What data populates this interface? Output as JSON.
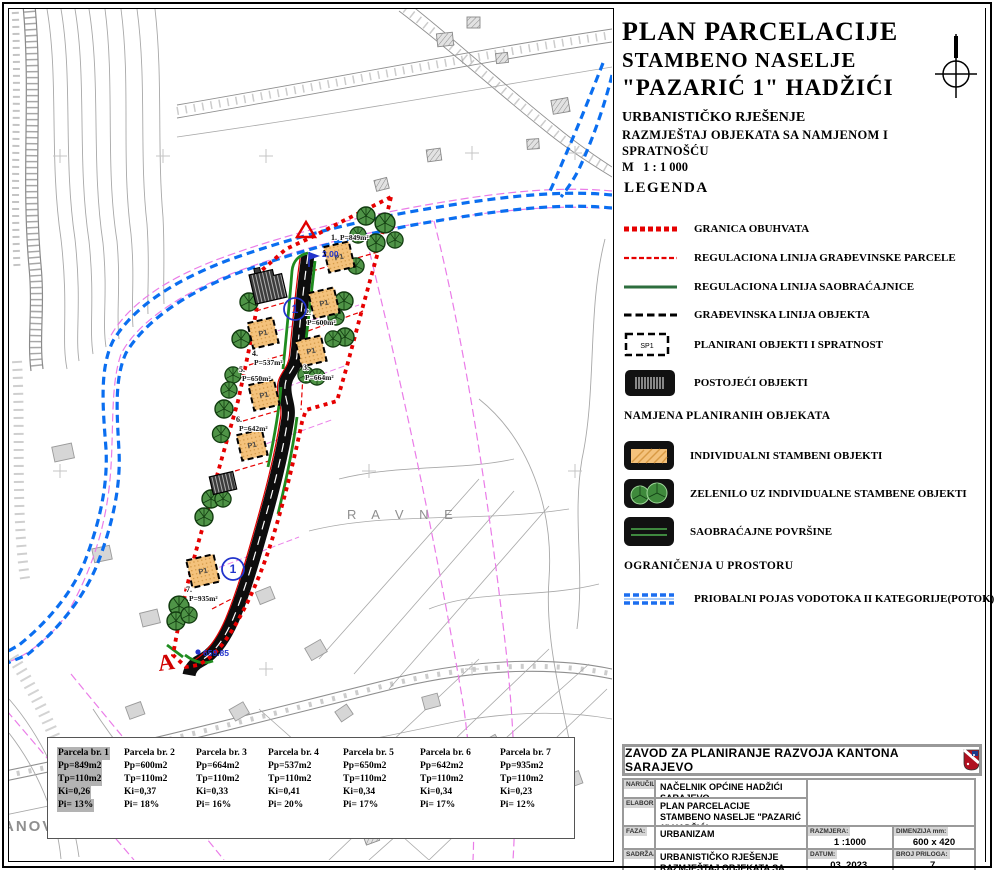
{
  "title_block": {
    "line1": "PLAN PARCELACIJE",
    "line2": "STAMBENO NASELJE",
    "line3": "\"PAZARIĆ 1\" HADŽIĆI",
    "subtitle1": "URBANISTIČKO RJEŠENJE",
    "subtitle2": "RAZMJEŠTAJ OBJEKATA SA NAMJENOM I SPRATNOŠĆU",
    "scale": "M   1 : 1 000"
  },
  "legend": {
    "heading": "LEGENDA",
    "items": [
      {
        "label": "GRANICA OBUHVATA"
      },
      {
        "label": "REGULACIONA LINIJA GRAĐEVINSKE PARCELE"
      },
      {
        "label": "REGULACIONA LINIJA  SAOBRAĆAJNICE"
      },
      {
        "label": "GRAĐEVINSKA LINIJA OBJEKTA"
      },
      {
        "label": "PLANIRANI OBJEKTI I SPRATNOST",
        "symbol_text": "SP1"
      },
      {
        "label": "POSTOJEĆI OBJEKTI"
      }
    ],
    "namjena_heading": "NAMJENA PLANIRANIH OBJEKATA",
    "namjena_items": [
      {
        "label": "INDIVIDUALNI STAMBENI OBJEKTI"
      },
      {
        "label": "ZELENILO UZ INDIVIDUALNE STAMBENE OBJEKTI"
      },
      {
        "label": "SAOBRAĆAJNE POVRŠINE"
      }
    ],
    "ogranicenja_heading": "OGRANIČENJA U PROSTORU",
    "ogranicenja_items": [
      {
        "label": "PRIOBALNI POJAS VODOTOKA  II KATEGORIJE(POTOK)"
      }
    ]
  },
  "parcels": [
    {
      "title": "Parcela br. 1",
      "pp": "Pp=849m2",
      "tp": "Tp=110m2",
      "ki": "Ki=0,26",
      "pi": "Pi= 13%",
      "highlight": true
    },
    {
      "title": "Parcela br. 2",
      "pp": "Pp=600m2",
      "tp": "Tp=110m2",
      "ki": "Ki=0,37",
      "pi": "Pi= 18%",
      "highlight": false
    },
    {
      "title": "Parcela br. 3",
      "pp": "Pp=664m2",
      "tp": "Tp=110m2",
      "ki": "Ki=0,33",
      "pi": "Pi= 16%",
      "highlight": false
    },
    {
      "title": "Parcela br. 4",
      "pp": "Pp=537m2",
      "tp": "Tp=110m2",
      "ki": "Ki=0,41",
      "pi": "Pi= 20%",
      "highlight": false
    },
    {
      "title": "Parcela br. 5",
      "pp": "Pp=650m2",
      "tp": "Tp=110m2",
      "ki": "Ki=0,34",
      "pi": "Pi= 17%",
      "highlight": false
    },
    {
      "title": "Parcela br. 6",
      "pp": "Pp=642m2",
      "tp": "Tp=110m2",
      "ki": "Ki=0,34",
      "pi": "Pi= 17%",
      "highlight": false
    },
    {
      "title": "Parcela br. 7",
      "pp": "Pp=935m2",
      "tp": "Tp=110m2",
      "ki": "Ki=0,23",
      "pi": "Pi= 12%",
      "highlight": false
    }
  ],
  "footer": {
    "org": "ZAVOD ZA PLANIRANJE RAZVOJA KANTONA SARAJEVO",
    "narucilac_label": "NARUČILAC:",
    "narucilac": "NAČELNIK OPĆINE HADŽIĆI SARAJEVO",
    "elaborat_label": "ELABORAT:",
    "elaborat": "PLAN PARCELACIJE  STAMBENO NASELJE \"PAZARIĆ 1\" HADŽIĆI",
    "faza_label": "FAZA:",
    "faza": "URBANIZAM",
    "sadrzaj_label": "SADRŽAJ:",
    "sadrzaj_line1": "URBANISTIČKO RJEŠENJE",
    "sadrzaj_line2": "RAZMJEŠTAJ OBJEKATA SA NAMJENOM I SPRATNOŠĆU",
    "razmjera_label": "RAZMJERA:",
    "razmjera": "1 :1000",
    "dimenzija_label": "DIMENZIJA mm:",
    "dimenzija": "600 x 420",
    "datum_label": "DATUM:",
    "datum": "03. 2023.",
    "broj_label": "BROJ PRILOGA:",
    "broj": "7."
  },
  "map": {
    "place_label_ravne": "R A V N E",
    "place_label_anovici": "ANOVIĆI",
    "building_label": "P1",
    "road_marker": "1",
    "width_note": "2,00",
    "elevation_note": "659.85",
    "section_marker": "A",
    "parcel_labels": [
      {
        "num": "1.",
        "area": "P=849m²"
      },
      {
        "num": "2.",
        "area": "P=600m²"
      },
      {
        "num": "3.",
        "area": "P=664m²"
      },
      {
        "num": "4.",
        "area": "P=537m²"
      },
      {
        "num": "5.",
        "area": "P=650m²"
      },
      {
        "num": "6.",
        "area": "P=642m²"
      },
      {
        "num": "7.",
        "area": "P=935m²"
      }
    ],
    "colors": {
      "boundary_red": "#e60000",
      "stream_blue": "#0a6ef0",
      "regulation_magenta": "#ea7ce8",
      "road_black": "#0d0d0d",
      "road_green_edge": "#1f8c1f",
      "building_orange": "#f4c27c",
      "tree_green": "#4f9447",
      "annotation_blue": "#2233cc",
      "basemap_gray": "#a8a8a8"
    }
  }
}
